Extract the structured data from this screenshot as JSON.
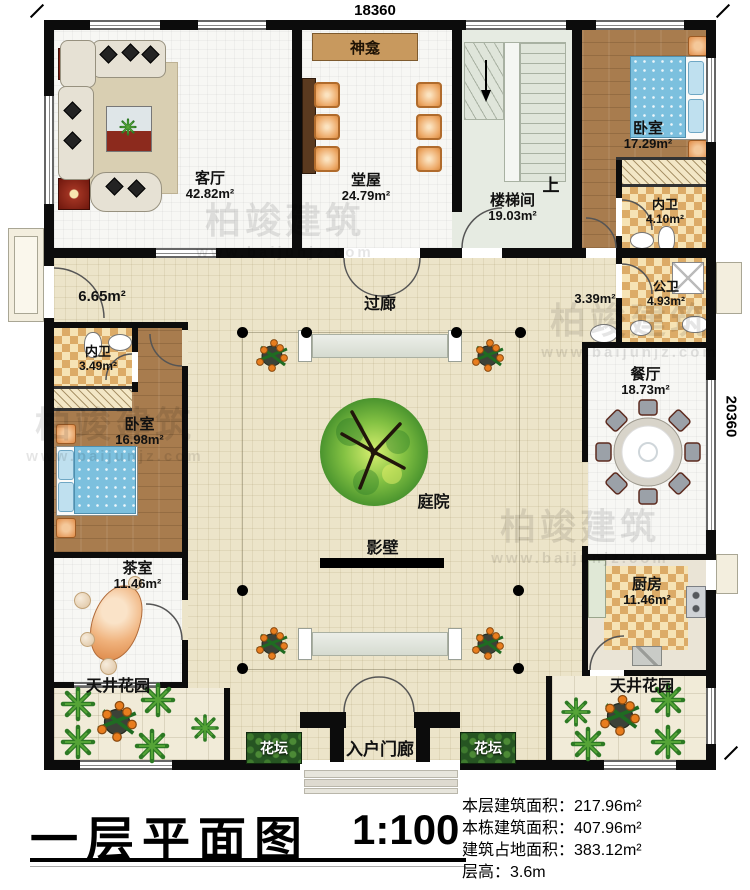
{
  "dimensions": {
    "top": "18360",
    "right": "20360"
  },
  "rooms": {
    "living": {
      "name": "客厅",
      "area": "42.82m²"
    },
    "hall": {
      "name": "堂屋",
      "area": "24.79m²"
    },
    "shrine": {
      "name": "神龛"
    },
    "stair": {
      "name": "楼梯间",
      "area": "19.03m²",
      "up": "上"
    },
    "bedroom_tr": {
      "name": "卧室",
      "area": "17.29m²"
    },
    "bath_tr": {
      "name": "内卫",
      "area": "4.10m²"
    },
    "public_bath": {
      "name": "公卫",
      "area": "4.93m²"
    },
    "wash": {
      "area": "3.39m²"
    },
    "dining": {
      "name": "餐厅",
      "area": "18.73m²"
    },
    "kitchen": {
      "name": "厨房",
      "area": "11.46m²"
    },
    "patio_right": {
      "name": "天井花园"
    },
    "patio_left": {
      "name": "天井花园"
    },
    "flowerbed": {
      "name": "花坛"
    },
    "entrance": {
      "name": "入户门廊"
    },
    "tea": {
      "name": "茶室",
      "area": "11.46m²"
    },
    "bedroom_l": {
      "name": "卧室",
      "area": "16.98m²"
    },
    "bath_l": {
      "name": "内卫",
      "area": "3.49m²"
    },
    "porch_l": {
      "area": "6.65m²"
    },
    "corridor": {
      "name": "过廊"
    },
    "courtyard": {
      "name": "庭院"
    },
    "screen_wall": {
      "name": "影壁"
    }
  },
  "titleblock": {
    "title": "一层平面图",
    "scale": "1:100"
  },
  "stats": [
    {
      "label": "本层建筑面积：",
      "value": "217.96m²"
    },
    {
      "label": "本栋建筑面积：",
      "value": "407.96m²"
    },
    {
      "label": "建筑占地面积：",
      "value": "383.12m²"
    },
    {
      "label": "层高：",
      "value": "3.6m"
    }
  ],
  "watermark": {
    "brand": "柏竣建筑",
    "site": "www.baijunjz.com"
  }
}
